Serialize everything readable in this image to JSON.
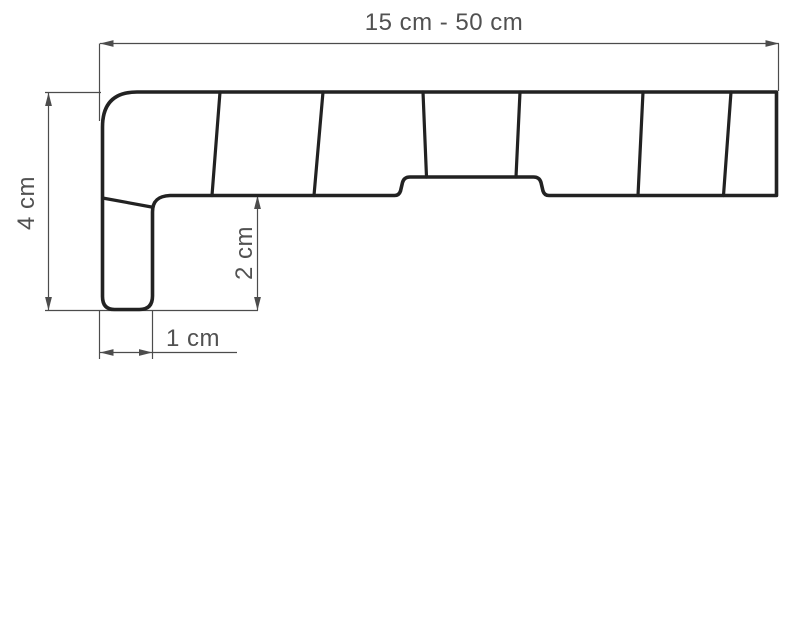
{
  "dimensions": {
    "width": {
      "label": "15 cm - 50 cm"
    },
    "height": {
      "label": "4 cm"
    },
    "depth": {
      "label": "2 cm"
    },
    "foot": {
      "label": "1 cm"
    }
  },
  "colors": {
    "outline": "#222222",
    "dimension": "#4c4c4c",
    "label": "#515151",
    "background": "#ffffff"
  }
}
